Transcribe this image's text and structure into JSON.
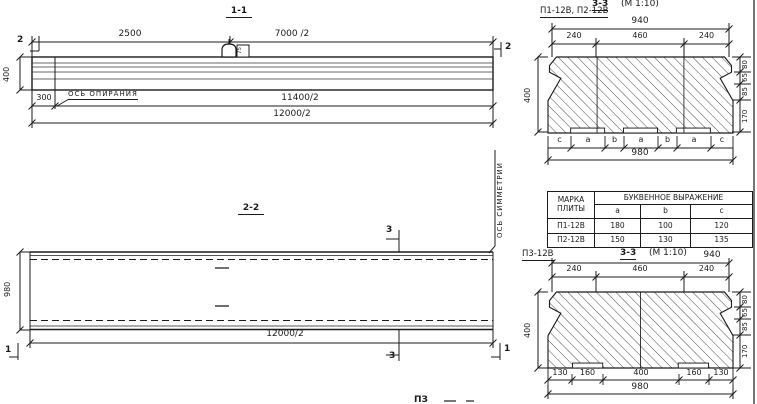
{
  "s11": {
    "title": "1-1",
    "dim_2500": "2500",
    "dim_7000_2": "7000 /2",
    "marker_left": "2",
    "marker_right": "2",
    "hook_label": "75",
    "dim_400": "400",
    "dim_300": "300",
    "support_axis_label": "ОСЬ ОПИРАНИЯ",
    "dim_11400_2": "11400/2",
    "dim_12000_2": "12000/2"
  },
  "s22": {
    "title": "2-2",
    "dim_980": "980",
    "dim_12000_2": "12000/2",
    "marker_3_top": "3",
    "marker_3_bottom": "3",
    "marker_1_left": "1",
    "marker_1_right": "1",
    "symmetry_axis_label": "ОСЬ СИММЕТРИИ"
  },
  "cs12": {
    "label": "П1-12В, П2-12В",
    "title": "3-3",
    "scale": "(М 1:10)",
    "dim_940": "940",
    "dims_top": [
      "240",
      "460",
      "240"
    ],
    "dim_400": "400",
    "dims_right": [
      "80",
      "65",
      "85",
      "170"
    ],
    "letters": [
      "c",
      "a",
      "b",
      "a",
      "b",
      "a",
      "c"
    ],
    "dim_980": "980"
  },
  "table": {
    "col1_line1": "МАРКА",
    "col1_line2": "ПЛИТЫ",
    "span_header": "БУКВЕННОЕ ВЫРАЖЕНИЕ",
    "cols": [
      "a",
      "b",
      "c"
    ],
    "rows": [
      {
        "mark": "П1-12В",
        "a": "180",
        "b": "100",
        "c": "120"
      },
      {
        "mark": "П2-12В",
        "a": "150",
        "b": "130",
        "c": "135"
      }
    ]
  },
  "cs3": {
    "label": "П3-12В",
    "title": "3-3",
    "scale": "(М 1:10)",
    "dim_940": "940",
    "dims_top": [
      "240",
      "460",
      "240"
    ],
    "dim_400": "400",
    "dims_right": [
      "80",
      "65",
      "85",
      "170"
    ],
    "dims_bottom": [
      "130",
      "160",
      "400",
      "160",
      "130"
    ],
    "dim_980": "980"
  },
  "misc": {
    "fragment": "ПЗ"
  },
  "colors": {
    "ink": "#1b1b1b",
    "paper": "#ffffff"
  }
}
